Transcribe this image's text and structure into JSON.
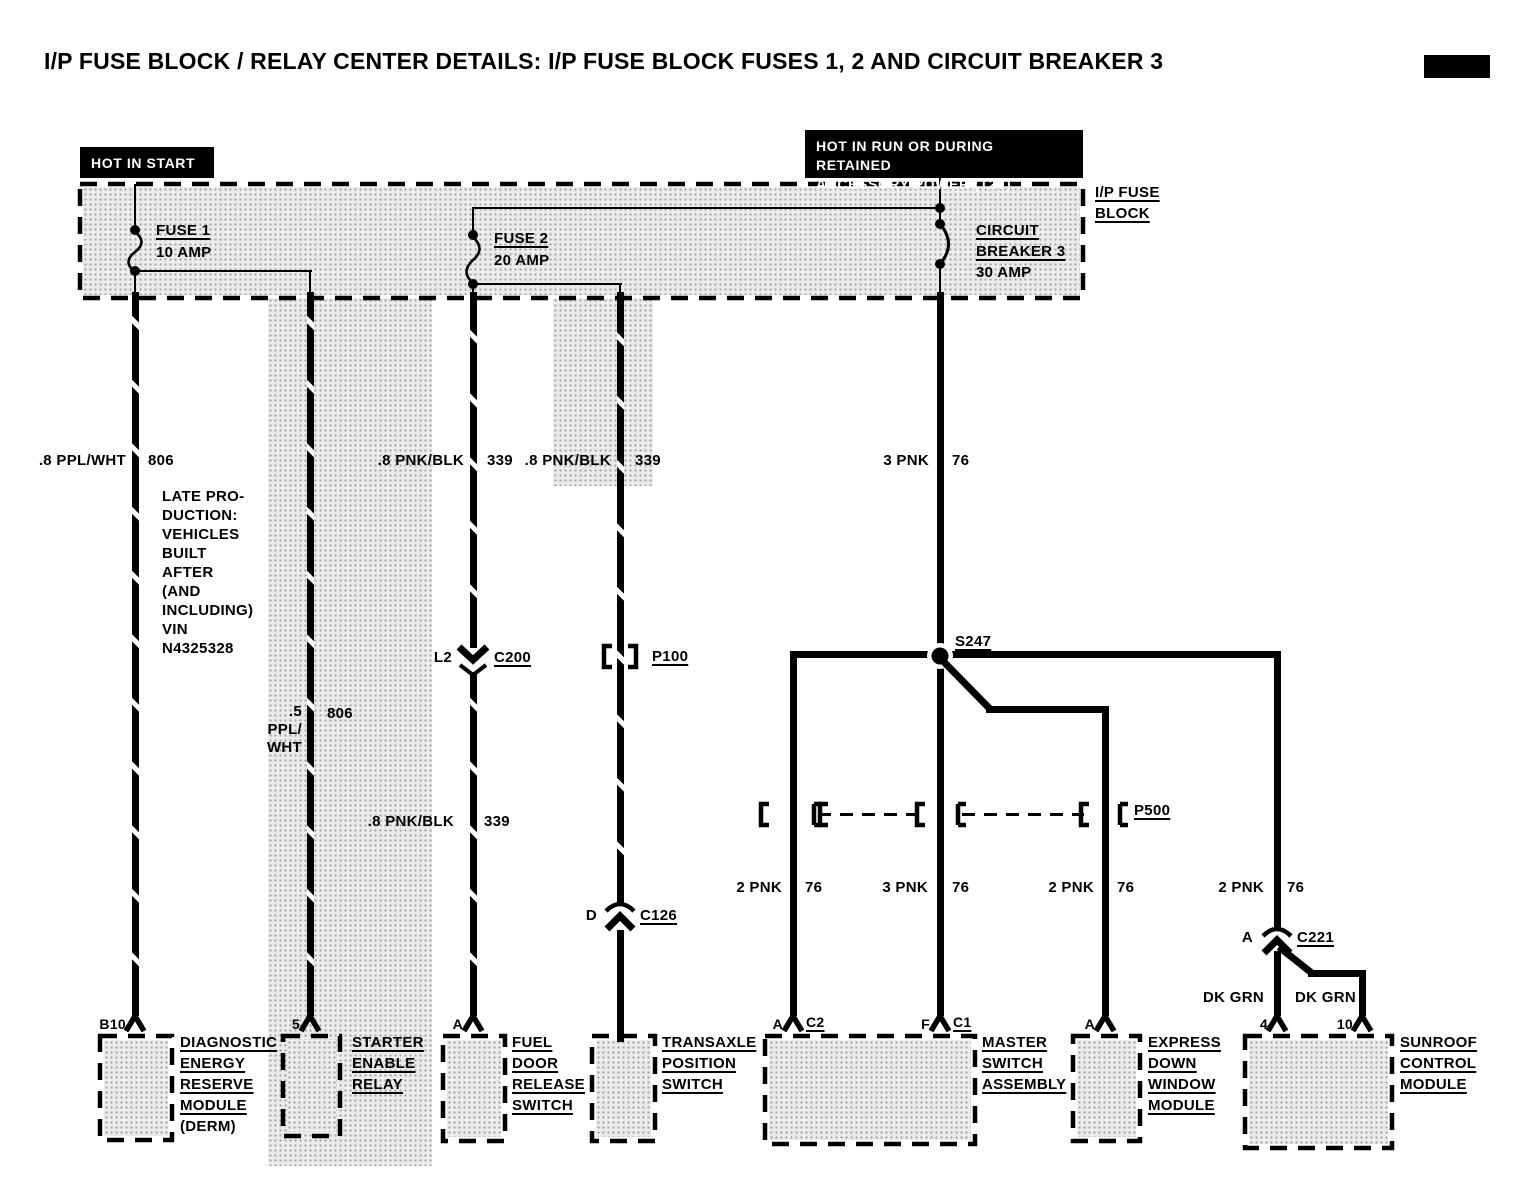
{
  "title": "I/P FUSE BLOCK / RELAY CENTER DETAILS: I/P FUSE BLOCK FUSES 1, 2 AND CIRCUIT BREAKER 3",
  "power_sources": {
    "hot_in_start": "HOT IN START",
    "hot_in_run_line1": "HOT IN RUN OR DURING RETAINED",
    "hot_in_run_line2": "ACCESSORY POWER (T2T)"
  },
  "fuse_block": {
    "label_line1": "I/P FUSE",
    "label_line2": "BLOCK",
    "fuse1_name": "FUSE 1",
    "fuse1_rating": "10 AMP",
    "fuse2_name": "FUSE 2",
    "fuse2_rating": "20 AMP",
    "breaker_line1": "CIRCUIT",
    "breaker_line2": "BREAKER 3",
    "breaker_rating": "30 AMP"
  },
  "note": {
    "lines": [
      "LATE PRO-",
      "DUCTION:",
      "VEHICLES",
      "BUILT",
      "AFTER",
      "(AND",
      "INCLUDING)",
      "VIN",
      "N4325328"
    ]
  },
  "wires": {
    "w1_color": ".8 PPL/WHT",
    "w1_circuit": "806",
    "w2_color_l1": ".5",
    "w2_color_l2": "PPL/",
    "w2_color_l3": "WHT",
    "w2_circuit": "806",
    "w3_color": ".8 PNK/BLK",
    "w3_circuit": "339",
    "w3b_color": ".8 PNK/BLK",
    "w3b_circuit": "339",
    "w4_color": ".8 PNK/BLK",
    "w4_circuit": "339",
    "w5_color": "3 PNK",
    "w5_circuit": "76",
    "b1_color": "2 PNK",
    "b1_circuit": "76",
    "b2_color": "3 PNK",
    "b2_circuit": "76",
    "b3_color": "2 PNK",
    "b3_circuit": "76",
    "b4_color": "2 PNK",
    "b4_circuit": "76",
    "sun1_color": "DK GRN",
    "sun2_color": "DK GRN"
  },
  "connectors": {
    "c200_pin": "L2",
    "c200": "C200",
    "p100": "P100",
    "s247": "S247",
    "p500": "P500",
    "c126_pin": "D",
    "c126": "C126",
    "c221_pin": "A",
    "c221": "C221"
  },
  "modules": {
    "derm": {
      "pin": "B10",
      "lines": [
        "DIAGNOSTIC",
        "ENERGY",
        "RESERVE",
        "MODULE"
      ],
      "suffix": "(DERM)"
    },
    "starter": {
      "pin": "5",
      "lines": [
        "STARTER",
        "ENABLE",
        "RELAY"
      ]
    },
    "fuel_door": {
      "pin": "A",
      "lines": [
        "FUEL",
        "DOOR",
        "RELEASE",
        "SWITCH"
      ]
    },
    "transaxle": {
      "lines": [
        "TRANSAXLE",
        "POSITION",
        "SWITCH"
      ]
    },
    "master": {
      "pin_a": "A",
      "conn_a": "C2",
      "pin_f": "F",
      "conn_f": "C1",
      "lines": [
        "MASTER",
        "SWITCH",
        "ASSEMBLY"
      ]
    },
    "express": {
      "pin": "A",
      "lines": [
        "EXPRESS",
        "DOWN",
        "WINDOW",
        "MODULE"
      ]
    },
    "sunroof": {
      "pin_4": "4",
      "pin_10": "10",
      "lines": [
        "SUNROOF",
        "CONTROL",
        "MODULE"
      ]
    }
  }
}
